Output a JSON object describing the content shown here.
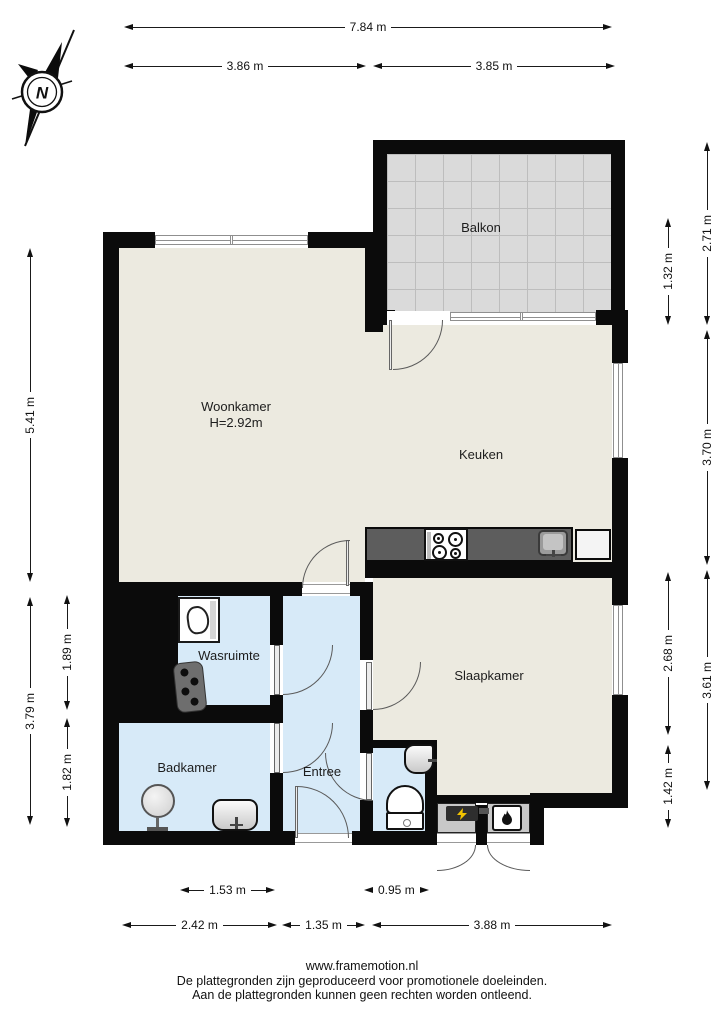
{
  "title": "Plattegrond appartement",
  "colors": {
    "wall": "#0b0b0b",
    "floor_main": "#ECEAE0",
    "floor_wet": "#D7EAF8",
    "floor_balcony": "#DADADA",
    "balcony_grid": "#BDBDBD",
    "counter": "#5D5D5D",
    "closet": "#C8C8C8",
    "door": "#5a5a5a",
    "window": "#8F8F8F",
    "bolt": "#F2C300"
  },
  "compass": {
    "north_label": "N"
  },
  "rooms": {
    "balkon": {
      "label": "Balkon"
    },
    "woonkamer": {
      "label": "Woonkamer",
      "ceiling_height": "H=2.92m"
    },
    "keuken": {
      "label": "Keuken"
    },
    "wasruimte": {
      "label": "Wasruimte"
    },
    "badkamer": {
      "label": "Badkamer"
    },
    "entree": {
      "label": "Entree"
    },
    "slaapkamer": {
      "label": "Slaapkamer"
    }
  },
  "dims": {
    "total_width": "7.84 m",
    "width_left": "3.86 m",
    "width_right": "3.85 m",
    "balcony_height": "2.71 m",
    "balcony_lower": "1.32 m",
    "kitchen_height": "3.70 m",
    "bedroom_upper": "2.68 m",
    "bedroom_height": "3.61 m",
    "bedroom_lower": "1.42 m",
    "livingroom_height": "5.41 m",
    "laundry_height": "1.89 m",
    "lower_left_height": "3.79 m",
    "bathroom_height": "1.82 m",
    "laundry_width": "1.53 m",
    "wc_width": "0.95 m",
    "bathroom_width": "2.42 m",
    "hall_width": "1.35 m",
    "bedroom_width": "3.88 m"
  },
  "icons": {
    "compass": "compass-rose",
    "washing_machine": "washing-machine",
    "boiler": "boiler-unit",
    "shower": "shower-head",
    "washbasin": "washbasin",
    "toilet": "toilet",
    "corner_basin": "corner-washbasin",
    "stove": "stove-burners",
    "sink": "kitchen-sink",
    "meter": "electric-meter",
    "flame": "heater-flame"
  },
  "footer": {
    "website": "www.framemotion.nl",
    "disclaimer_line1": "De plattegronden zijn geproduceerd voor promotionele doeleinden.",
    "disclaimer_line2": "Aan de plattegronden kunnen geen rechten worden ontleend."
  }
}
